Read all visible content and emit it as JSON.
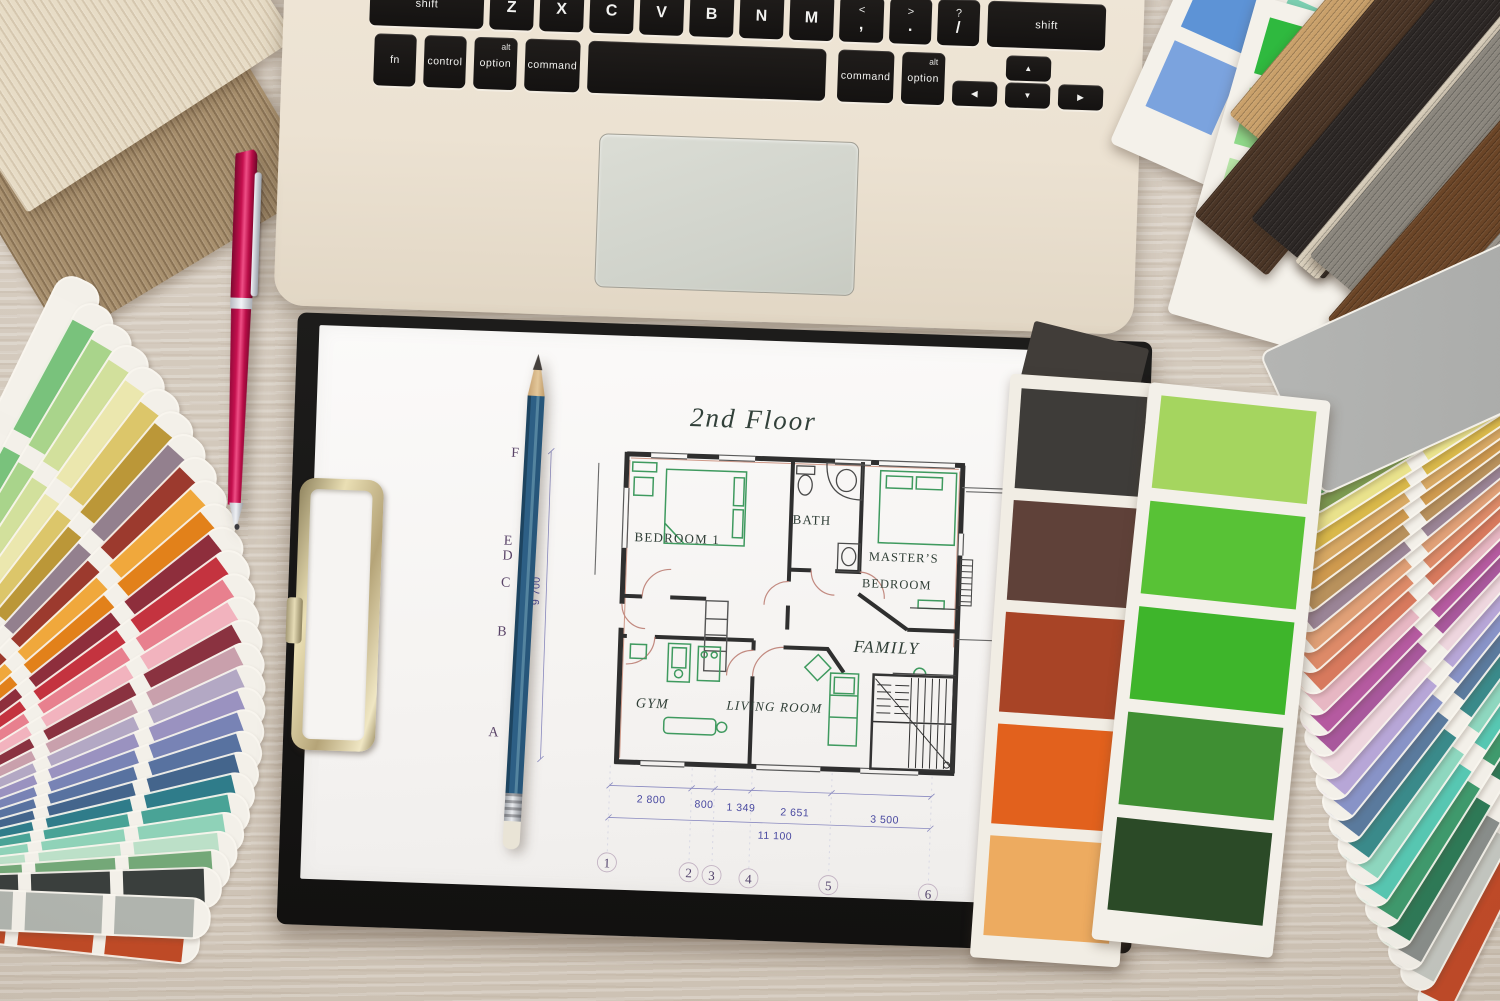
{
  "scene": {
    "description": "Top-down photo of an interior designer workspace: laptop keyboard, clipboard with 2nd floor plan, pencil, pink pen, paint swatch fans, color cards and wood samples on a whitewashed desk"
  },
  "laptop": {
    "letter_keys": [
      {
        "main": "shift"
      },
      {
        "main": "Z"
      },
      {
        "main": "X"
      },
      {
        "main": "C"
      },
      {
        "main": "V"
      },
      {
        "main": "B"
      },
      {
        "main": "N"
      },
      {
        "main": "M"
      },
      {
        "main": "<",
        "sub": ","
      },
      {
        "main": ">",
        "sub": "."
      },
      {
        "main": "?",
        "sub": "/"
      },
      {
        "main": "shift"
      }
    ],
    "modifier_keys": [
      {
        "main": "fn"
      },
      {
        "main": "control"
      },
      {
        "main": "option",
        "sub": "alt"
      },
      {
        "main": "command"
      },
      {
        "main": ""
      },
      {
        "main": "command"
      },
      {
        "main": "option",
        "sub": "alt"
      }
    ],
    "arrow_keys": {
      "left": "◀",
      "up": "▲",
      "down": "▼",
      "right": "▶"
    }
  },
  "floor_plan": {
    "title": "2nd Floor",
    "rooms": {
      "bedroom1": "BEDROOM 1",
      "bath": "BATH",
      "master_line1": "MASTER’S",
      "master_line2": "BEDROOM",
      "family": "FAMILY",
      "gym": "GYM",
      "living": "LIVING ROOM"
    },
    "grid_letters": [
      "F",
      "E",
      "D",
      "C",
      "B",
      "A"
    ],
    "grid_numbers": [
      "1",
      "2",
      "3",
      "4",
      "5",
      "6"
    ],
    "dimensions": {
      "horizontal": [
        "2 800",
        "800",
        "1 349",
        "2 651",
        "3 500"
      ],
      "total_width": "11 100",
      "height": "9 700"
    }
  },
  "palettes": {
    "green_card": [
      "#a5d55f",
      "#58c236",
      "#3eb52b",
      "#3f8f33",
      "#2b4a27"
    ],
    "brown_card": [
      "#3e3c39",
      "#5f4139",
      "#a84426",
      "#e2611d",
      "#edab60"
    ],
    "left_fan": [
      "#bf4a26",
      "#f4f1ea",
      "#79c27c",
      "#a9d48b",
      "#d2e09c",
      "#ebe7ae",
      "#dcc66a",
      "#bb9738",
      "#93808e",
      "#9c3a2e",
      "#f0a83c",
      "#e2811a",
      "#8e2e3c",
      "#c4333f",
      "#e8808e",
      "#f2b3be",
      "#8a3240",
      "#c9a0ac",
      "#b3a8c4",
      "#9a92c0",
      "#7883b5",
      "#5872a0",
      "#44658c",
      "#2f7c8a",
      "#49a396",
      "#8fd2b8",
      "#bce0c8",
      "#74a878",
      "#3a3f3d",
      "#b0b4ae"
    ],
    "right_fan": [
      "#c14a28",
      "#c4c7c1",
      "#898e8b",
      "#2e7a57",
      "#3f9a6d",
      "#57c7b2",
      "#8ed7bf",
      "#3a8a8a",
      "#5a7a9d",
      "#8893c7",
      "#b7a6d7",
      "#eed6de",
      "#a8589c",
      "#b55aa0",
      "#e7b7c3",
      "#d7795d",
      "#dd8a68",
      "#e0a077",
      "#9a8496",
      "#b8915c",
      "#cf9a4e",
      "#d8a964",
      "#d9b84a",
      "#e9e28c",
      "#7c9a50",
      "#53a75f",
      "#3fae8e",
      "#cfe2d5",
      "#d8d3da",
      "#a8a9a7"
    ],
    "cool_grid": [
      "#4c85cb",
      "#57c7a7",
      "#5abd63",
      "#5d93d6",
      "#7dd2b4",
      "#80cc86",
      "#7ba3de",
      "#98dac2",
      "#a4dba8"
    ],
    "bright_grid": [
      "#2fb93f",
      "#8ed03f",
      "#f5e32a",
      "#f08030",
      "#d93a4a",
      "#8fd98a",
      "#b5e06b",
      "#f0ee7a",
      "#f5b169",
      "#e25668",
      "#b8e6a8",
      "#d3ec96",
      "#f6f2a0",
      "#f8c990",
      "#eb8794"
    ],
    "wood_planks": [
      "#c9a06a",
      "#4a3526",
      "#2c2725",
      "#d9cfbc",
      "#8b867d",
      "#6b4527",
      "#99938a"
    ],
    "veneers": [
      "#c4a87e",
      "#a8906e",
      "#e7dcc6"
    ]
  },
  "stationery": {
    "pen_color": "#c4104e",
    "pencil_color": "#2d5f85",
    "clipboard_color": "#141312"
  }
}
